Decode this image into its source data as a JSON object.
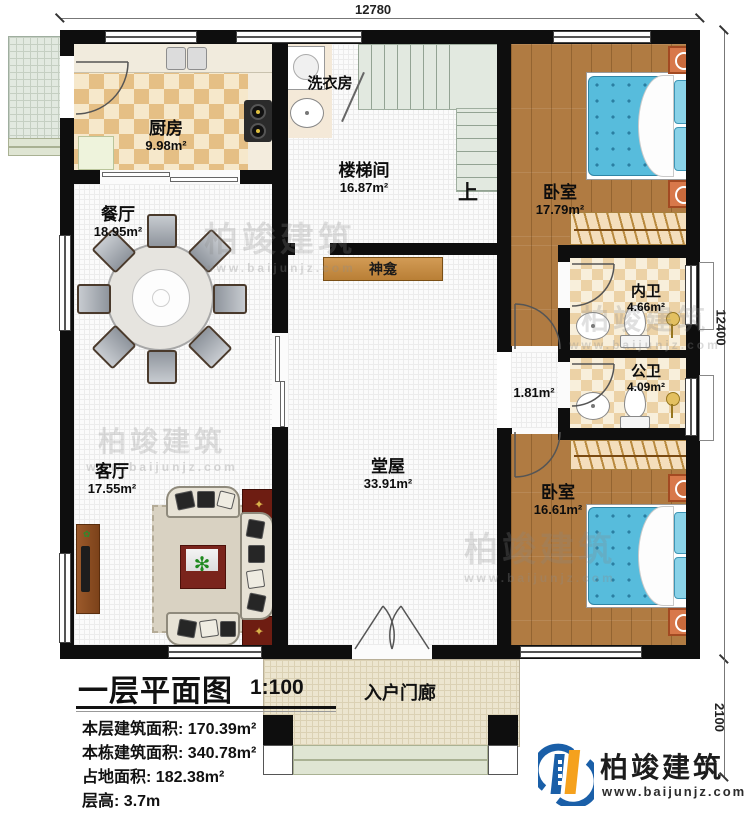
{
  "dimensions": {
    "top": "12780",
    "right": "12400",
    "porch_right": "2100"
  },
  "rooms": {
    "kitchen": {
      "name": "厨房",
      "area": "9.98m²"
    },
    "laundry": {
      "name": "洗衣房"
    },
    "stairwell": {
      "name": "楼梯间",
      "area": "16.87m²"
    },
    "stairs_up": "上",
    "bedroom1": {
      "name": "卧室",
      "area": "17.79m²"
    },
    "ensuite_bath": {
      "name": "内卫",
      "area": "4.66m²"
    },
    "public_bath": {
      "name": "公卫",
      "area": "4.09m²"
    },
    "hallway": {
      "area": "1.81m²"
    },
    "bedroom2": {
      "name": "卧室",
      "area": "16.61m²"
    },
    "dining": {
      "name": "餐厅",
      "area": "18.95m²"
    },
    "living": {
      "name": "客厅",
      "area": "17.55m²"
    },
    "main_hall": {
      "name": "堂屋",
      "area": "33.91m²"
    },
    "shrine": {
      "name": "神龛"
    },
    "porch": {
      "name": "入户门廊"
    }
  },
  "title_block": {
    "title": "一层平面图",
    "scale": "1:100",
    "stats": [
      {
        "label": "本层建筑面积:",
        "value": "170.39m²"
      },
      {
        "label": "本栋建筑面积:",
        "value": "340.78m²"
      },
      {
        "label": "占地面积:",
        "value": "182.38m²"
      },
      {
        "label": "层高:",
        "value": "3.7m"
      }
    ]
  },
  "brand": {
    "name": "柏竣建筑",
    "url": "www.baijunjz.com"
  },
  "watermark": {
    "text": "柏竣建筑",
    "url": "www.baijunjz.com"
  },
  "colors": {
    "wall": "#0e0e0e",
    "bed": "#57bcdc",
    "wood": "#b07b42",
    "logo_blue": "#1a5fa8",
    "logo_orange": "#f5a11d"
  }
}
